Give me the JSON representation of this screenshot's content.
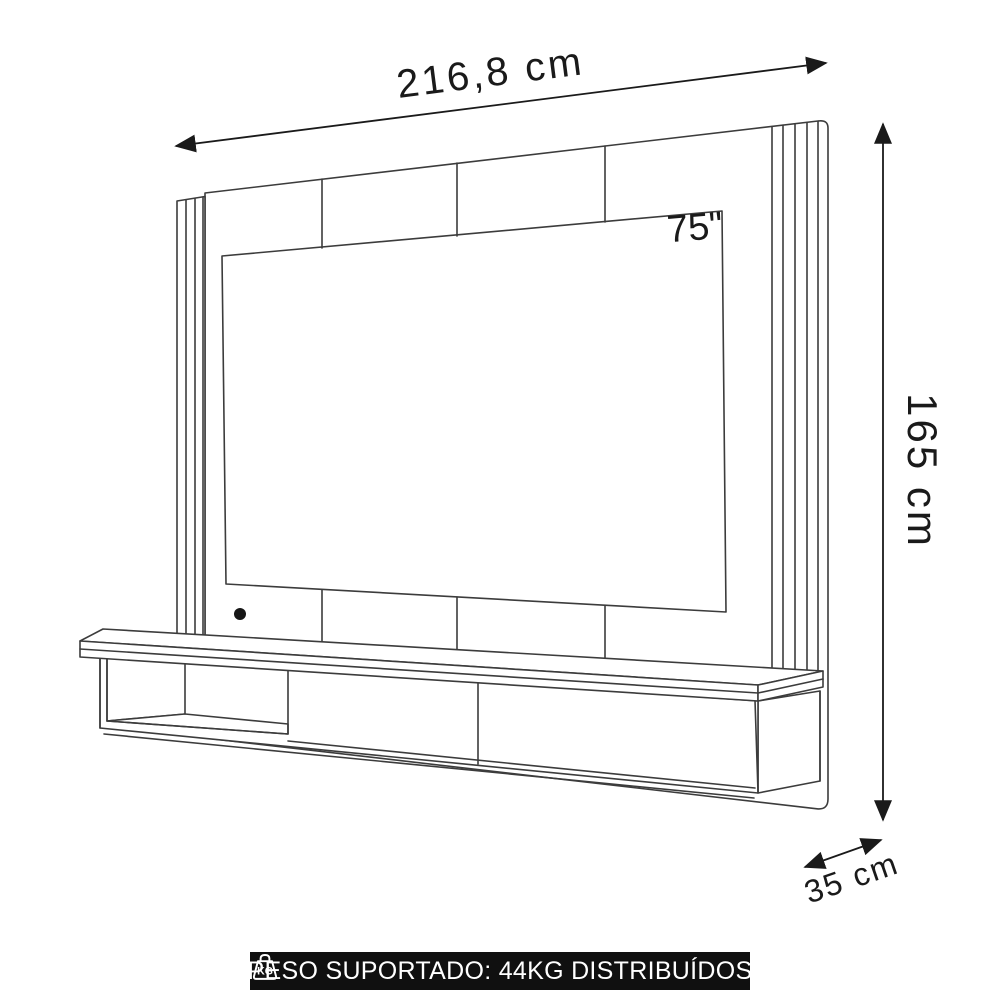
{
  "diagram": {
    "title": "TV wall panel with floating shelf - dimension diagram",
    "width_label": "216,8 cm",
    "height_label": "165 cm",
    "depth_label": "35 cm",
    "tv_size_label": "75\"",
    "colors": {
      "line": "#3c3c3c",
      "tv_fill": "#cac6c3",
      "dimension_text": "#1a1a1a",
      "banner_bg": "#101010",
      "banner_text": "#ffffff"
    }
  },
  "banner": {
    "icon": "kg-weight-icon",
    "icon_label": "KG",
    "text": "PESO SUPORTADO: 44KG DISTRIBUÍDOS"
  }
}
